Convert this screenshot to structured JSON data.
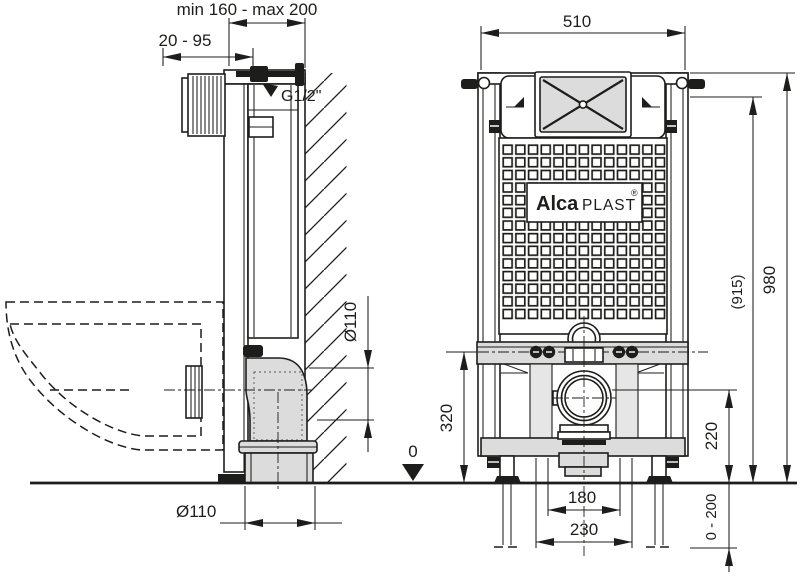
{
  "colors": {
    "line": "#1d1d1b",
    "fill_gray": "#dcdcdc",
    "background": "#ffffff"
  },
  "logo": {
    "bold": "Alca",
    "light": "PLAST",
    "registered": "®"
  },
  "side_view": {
    "depth_range": "min 160 - max 200",
    "inlet_range": "20 - 95",
    "water_connection": "G1/2\"",
    "outlet_dia_vertical": "Ø110",
    "outlet_dia_horizontal": "Ø110",
    "floor_datum": "0"
  },
  "front_view": {
    "width": "510",
    "height": "980",
    "height_alt": "(915)",
    "outlet_height": "320",
    "outlet_height_alt": "220",
    "spacing_inner": "180",
    "spacing_outer": "230",
    "leg_adjust_range": "0 - 200"
  }
}
